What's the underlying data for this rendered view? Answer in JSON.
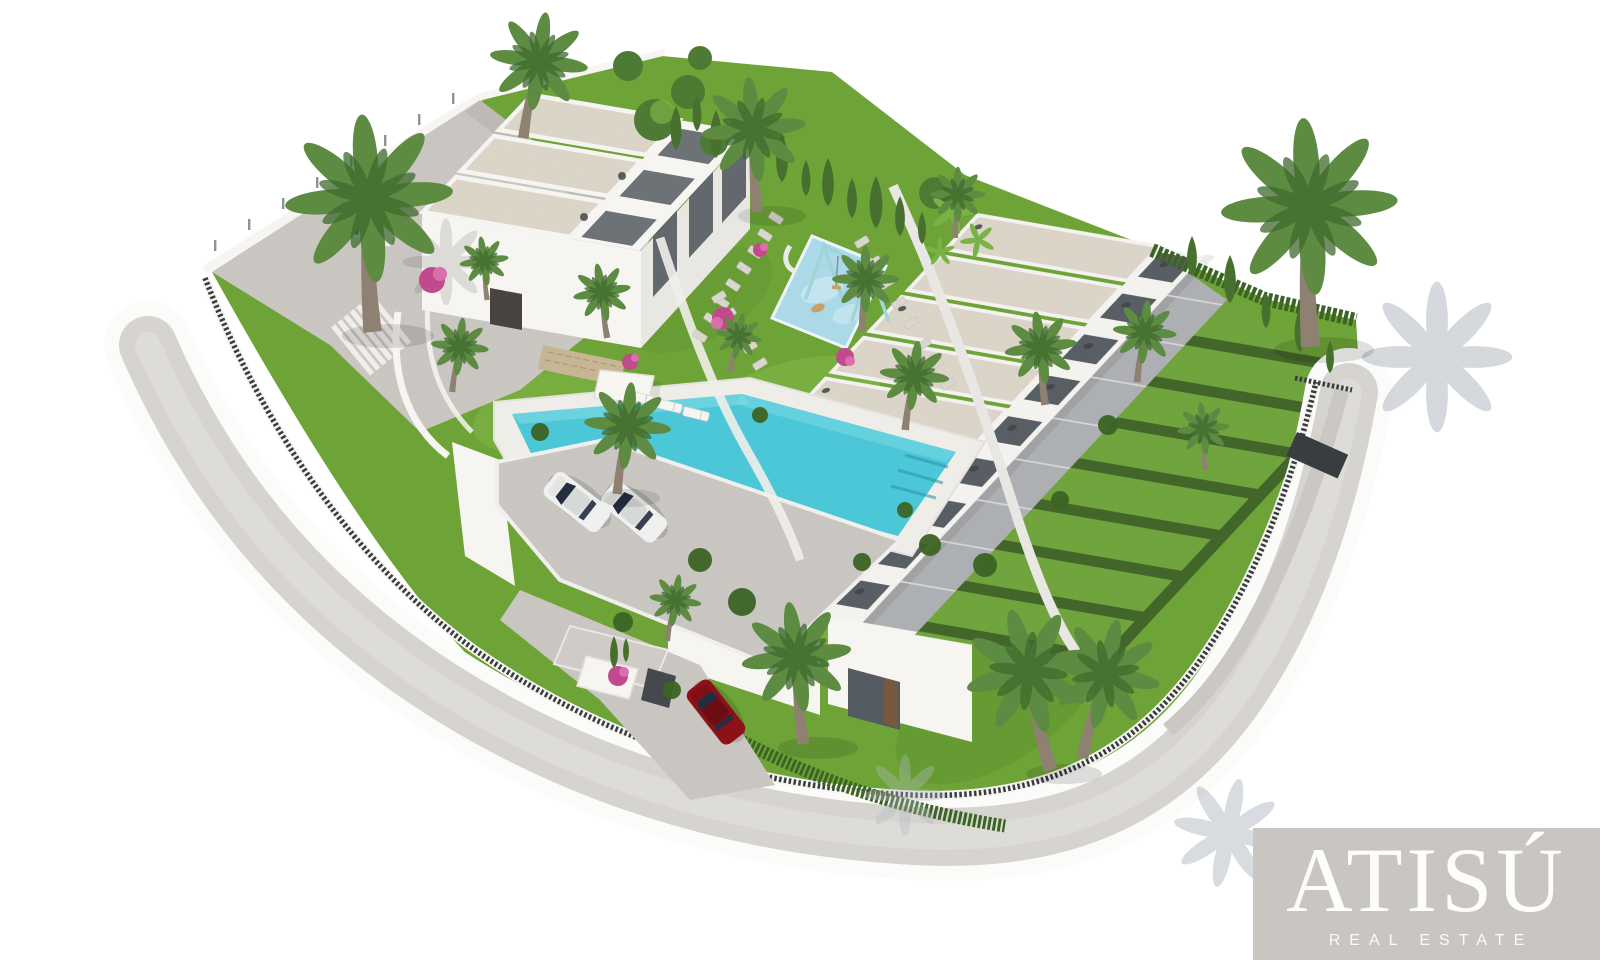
{
  "meta": {
    "type": "architectural-3d-render",
    "description": "Aerial 3D rendering of a new-build residential development: a detached villa block with private pool and parking on the left, a stepped row of nine townhouses with private gardens and hedges on the right, a central landscaped garden with a children's playground, palm trees, a gated entrance with a red car, all wrapped by a curved perimeter road on a white background."
  },
  "watermark": {
    "brand": "ATISÚ",
    "tagline": "REAL ESTATE"
  },
  "palette": {
    "bg": "#ffffff",
    "grass": "#6ea437",
    "grassLight": "#86bc4b",
    "grassDark": "#4f7d28",
    "hedge": "#3c6424",
    "cypress": "#47702f",
    "canopyTree": "#4d7b33",
    "banana": "#79b347",
    "palmFrond": "#5d8b41",
    "palmFrondDark": "#3f6a2e",
    "palmTrunk": "#8f8171",
    "roof": "#ddd7ca",
    "wallWhite": "#f6f5f2",
    "wallShade": "#e9e7e2",
    "road": "#d8d5d1",
    "roadLight": "#e4e2de",
    "curb": "#fbfbfa",
    "concrete": "#cbc8c3",
    "patio": "#aeb0b3",
    "glassDark": "#555b62",
    "fenceDark": "#393d40",
    "pool": "#4cc7d7",
    "poolLight": "#85dce6",
    "deck": "#efede7",
    "stone": "#c6b693",
    "playPad": "#abd9e7",
    "playFrame": "#9ed5d9",
    "carRed": "#8e1118",
    "carGlass": "#242e3f",
    "pink": "#c2498d",
    "pinkLight": "#da6fae",
    "shadow": "#b3b9c0",
    "doorBrown": "#7b5a3b",
    "logoBg": "#c9c6c2",
    "logoText": "#fdfdfc"
  },
  "scene": {
    "buildings": [
      {
        "name": "villa-block",
        "roof_units": 3,
        "features": [
          "flat beige roofs",
          "white facades",
          "dark glass doors",
          "roof terraces"
        ]
      },
      {
        "name": "townhouse-row",
        "roof_units": 9,
        "features": [
          "stepped row",
          "rear patios",
          "private hedged gardens"
        ]
      }
    ],
    "amenities": [
      "swimming-pool",
      "sun-deck-with-umbrella",
      "children-playground",
      "parking-area",
      "gated-entrance",
      "stepping-stone-paths"
    ],
    "vehicles": [
      {
        "type": "car",
        "color": "white",
        "location": "upper-driveway"
      },
      {
        "type": "car",
        "color": "white",
        "location": "parking"
      },
      {
        "type": "car",
        "color": "white",
        "location": "parking"
      },
      {
        "type": "car",
        "color": "red",
        "location": "entrance-drive"
      }
    ],
    "vegetation": [
      "palm-trees",
      "cypress-hedges",
      "bougainvillea",
      "lawns"
    ]
  }
}
